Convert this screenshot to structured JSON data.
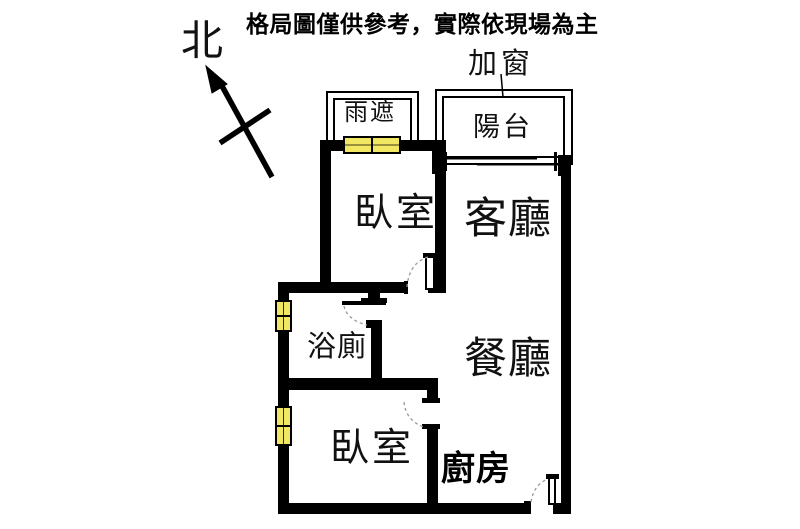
{
  "header": {
    "disclaimer": "格局圖僅供參考，實際依現場為主"
  },
  "compass": {
    "north_label": "北"
  },
  "callouts": {
    "added_window": "加窗",
    "rain_cover": "雨遮"
  },
  "rooms": {
    "balcony": "陽台",
    "bedroom_top": "臥室",
    "living_room": "客廳",
    "bathroom": "浴廁",
    "dining_room": "餐廳",
    "bedroom_bottom": "臥室",
    "kitchen": "廚房"
  },
  "colors": {
    "wall": "#000000",
    "window_fill": "#F2E763",
    "door_arc": "#9a9a9a",
    "background": "#FFFFFF",
    "text": "#000000"
  }
}
